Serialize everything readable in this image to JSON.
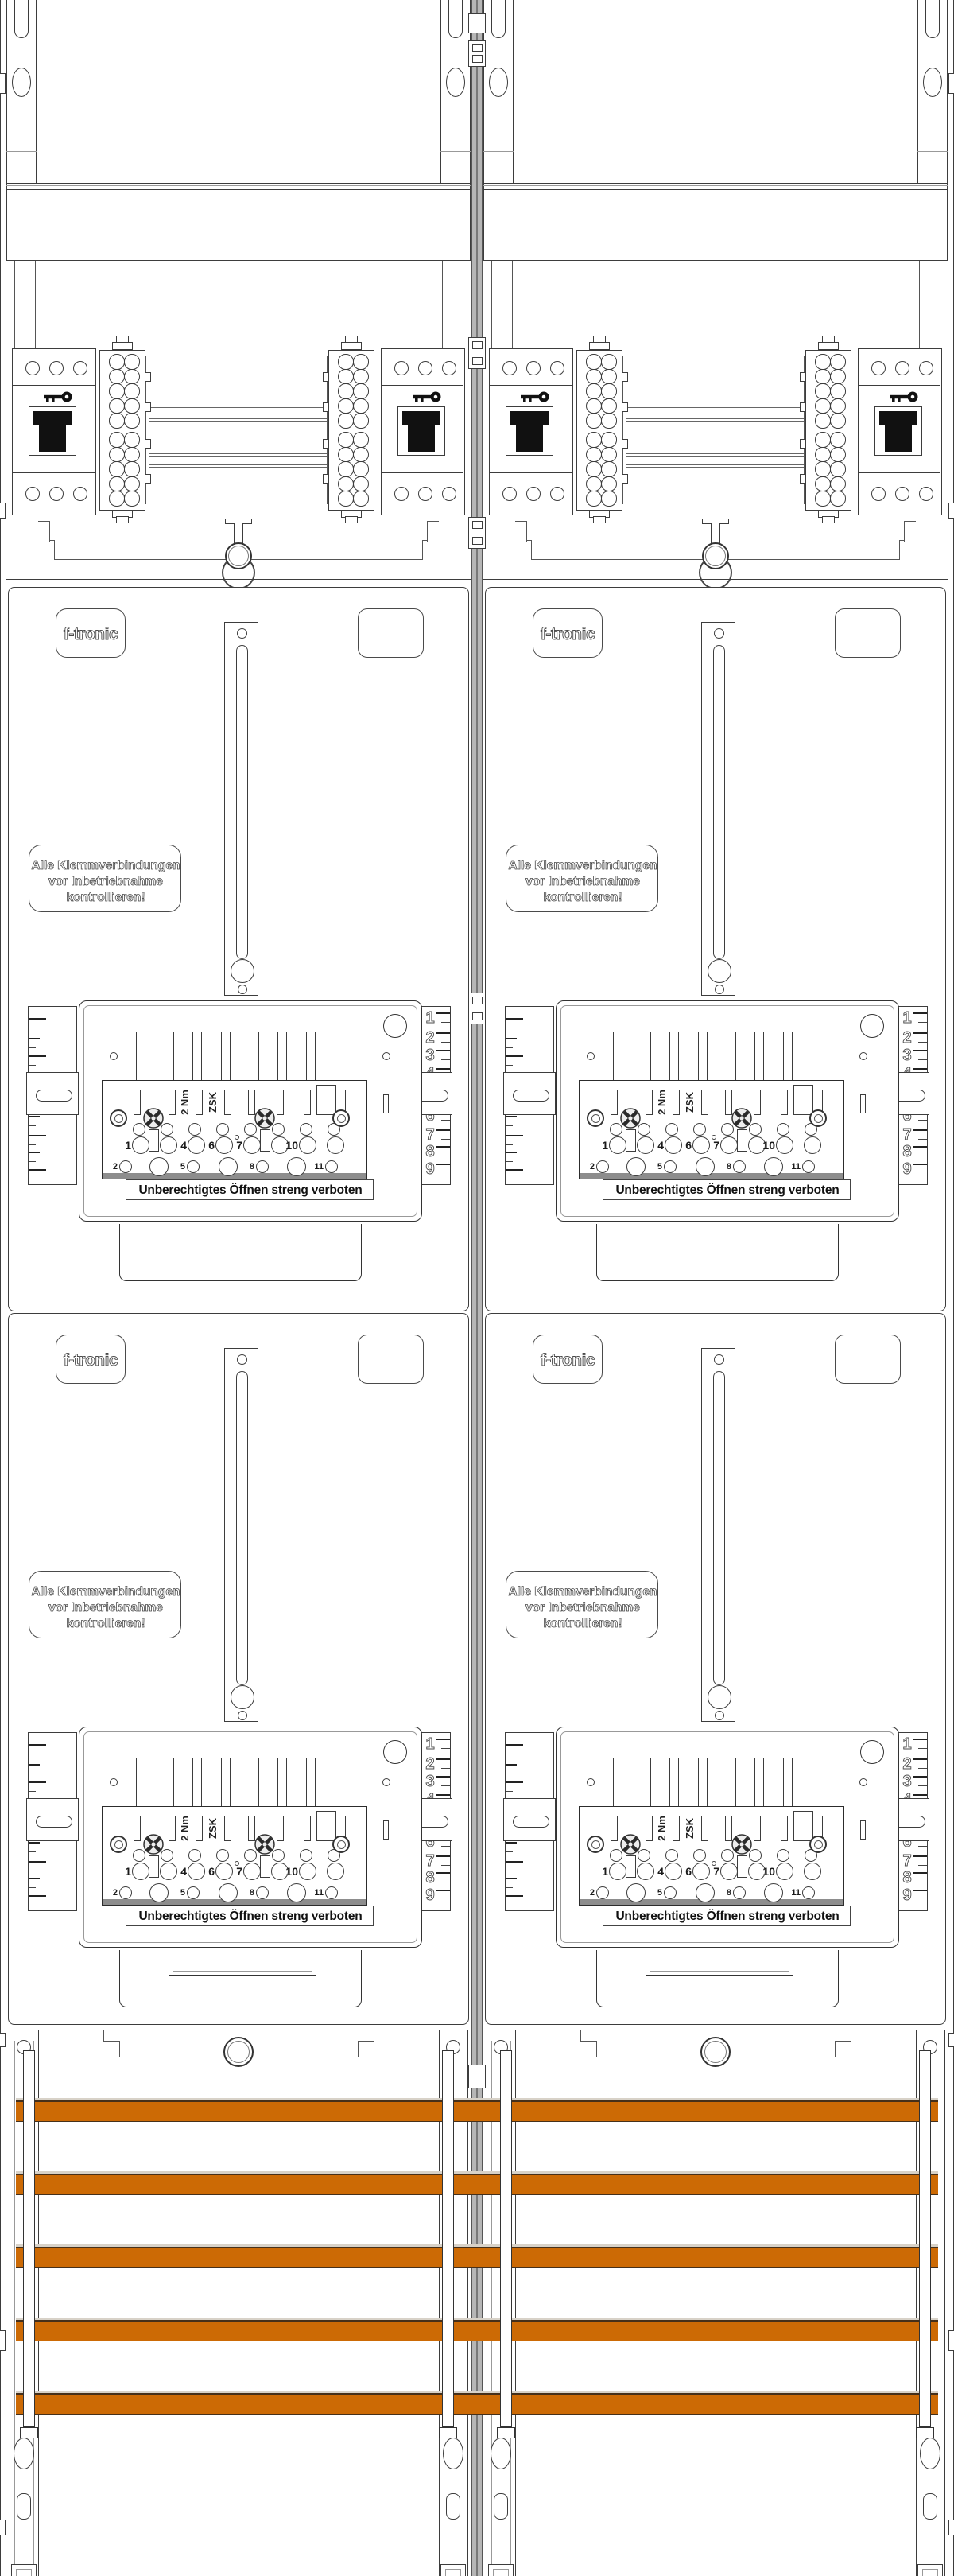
{
  "drawing": {
    "kind": "meter-cabinet front view",
    "columns": 2,
    "meter_panels_per_column": 2
  },
  "brand": {
    "logo_text": "f-tronic"
  },
  "labels": {
    "warning_lines": [
      "Alle Klemmverbindungen",
      "vor Inbetriebnahme",
      "kontrollieren!"
    ],
    "seal_warning": "Unberechtigtes Öffnen streng verboten",
    "torque": "2 Nm",
    "terminal_model": "ZSK"
  },
  "terminal_block": {
    "row_upper_numbers": [
      "1",
      "3",
      "4",
      "6",
      "7",
      "9",
      "10"
    ],
    "row_lower_numbers": [
      "2",
      "5",
      "8",
      "11"
    ],
    "rail_scale_numbers": [
      "1",
      "2",
      "3",
      "4",
      "5",
      "6",
      "7",
      "8",
      "9"
    ]
  },
  "busbars": {
    "count": 5,
    "color": "#CC6A05",
    "edge_color": "#46301a"
  },
  "colors": {
    "line_dark": "#3d3d3d",
    "line_light": "#999999",
    "junction_gray": "#b6b6b6",
    "switch_black": "#111111"
  }
}
